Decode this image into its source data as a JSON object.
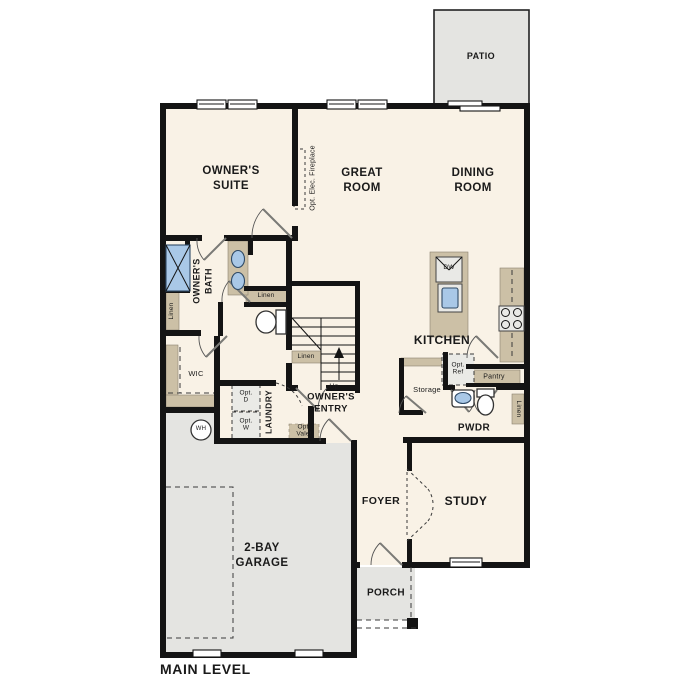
{
  "colors": {
    "wall": "#141414",
    "floor": "#f9f2e6",
    "outdoor": "#e4e4e1",
    "casework": "#ccc0a6",
    "fixture_blue": "#a9c8e7",
    "dashed_fill": "#eaeae6"
  },
  "plan_title": "MAIN LEVEL",
  "rooms": {
    "patio": "PATIO",
    "owners_suite": "OWNER'S\nSUITE",
    "great_room": "GREAT\nROOM",
    "dining_room": "DINING\nROOM",
    "owners_bath": "OWNER'S\nBATH",
    "wic": "WIC",
    "laundry": "LAUNDRY",
    "owners_entry": "OWNER'S\nENTRY",
    "kitchen": "KITCHEN",
    "storage": "Storage",
    "pwdr": "PWDR",
    "foyer": "FOYER",
    "study": "STUDY",
    "porch": "PORCH",
    "garage": "2-BAY\nGARAGE"
  },
  "features": {
    "opt_elec_fireplace": "Opt. Elec. Fireplace",
    "linen_bath": "Linen",
    "linen_hall": "Linen",
    "linen_stair": "Linen",
    "linen_pwdr": "Linen",
    "pantry": "Pantry",
    "opt_ref": "Opt.\nRef",
    "opt_dryer": "Opt.\nD",
    "opt_washer": "Opt.\nW",
    "opt_valet": "Opt.\nValet",
    "water_heater": "WH",
    "dishwasher": "DW",
    "stairs_up": "Up"
  }
}
